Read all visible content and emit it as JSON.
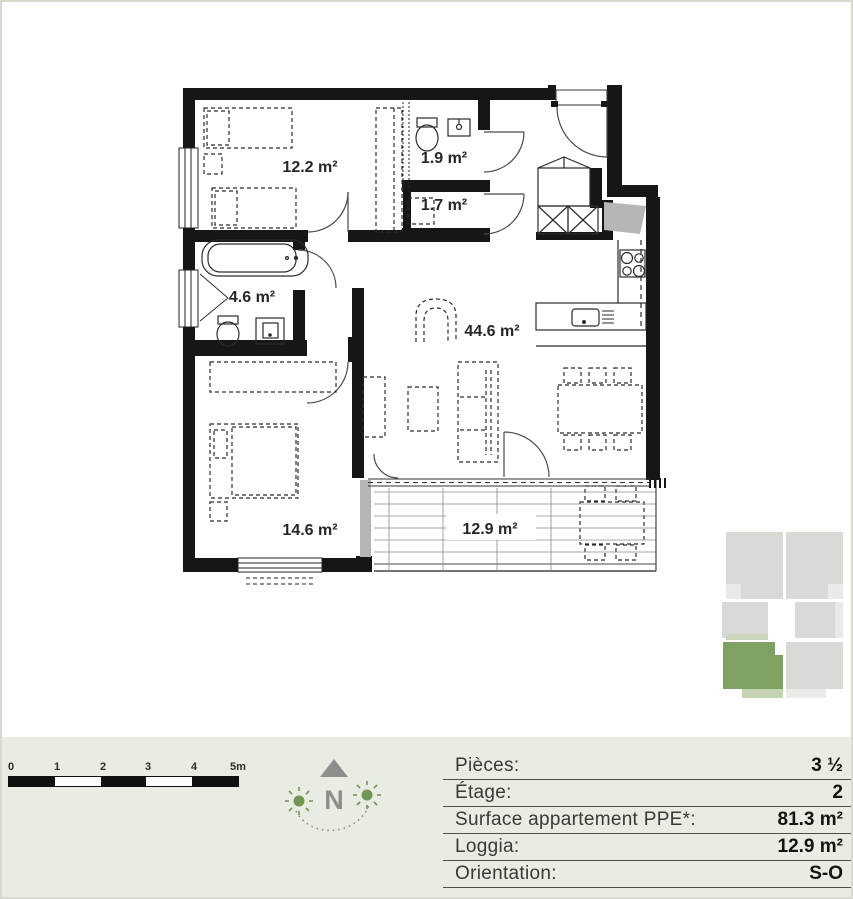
{
  "plan": {
    "rooms": [
      {
        "name": "chambre-1",
        "area_label": "12.2 m²"
      },
      {
        "name": "wc",
        "area_label": "1.9 m²"
      },
      {
        "name": "reduit",
        "area_label": "1.7 m²"
      },
      {
        "name": "salle-de-bains",
        "area_label": "4.6 m²"
      },
      {
        "name": "sejour-cuisine",
        "area_label": "44.6 m²"
      },
      {
        "name": "chambre-2",
        "area_label": "14.6 m²"
      },
      {
        "name": "loggia",
        "area_label": "12.9 m²"
      }
    ]
  },
  "scale_bar": {
    "ticks": [
      "0",
      "1",
      "2",
      "3",
      "4",
      "5m"
    ]
  },
  "compass": {
    "north_label": "N"
  },
  "info_table": {
    "rows": [
      {
        "label": "Pièces:",
        "value": "3 ½"
      },
      {
        "label": "Étage:",
        "value": "2"
      },
      {
        "label": "Surface appartement PPE*:",
        "value": "81.3 m²"
      },
      {
        "label": "Loggia:",
        "value": "12.9 m²"
      },
      {
        "label": "Orientation:",
        "value": "S-O"
      }
    ]
  },
  "mini_map": {
    "highlighted_unit": "bottom-left",
    "highlight_color": "#7ea262",
    "loggia_color": "#c4d4b3",
    "unit_color": "#d9d9d6"
  },
  "colors": {
    "band_background": "#e9ece3",
    "wall": "#161616",
    "shade_gray": "#b5b5b3",
    "page_border": "#d6dccd"
  }
}
